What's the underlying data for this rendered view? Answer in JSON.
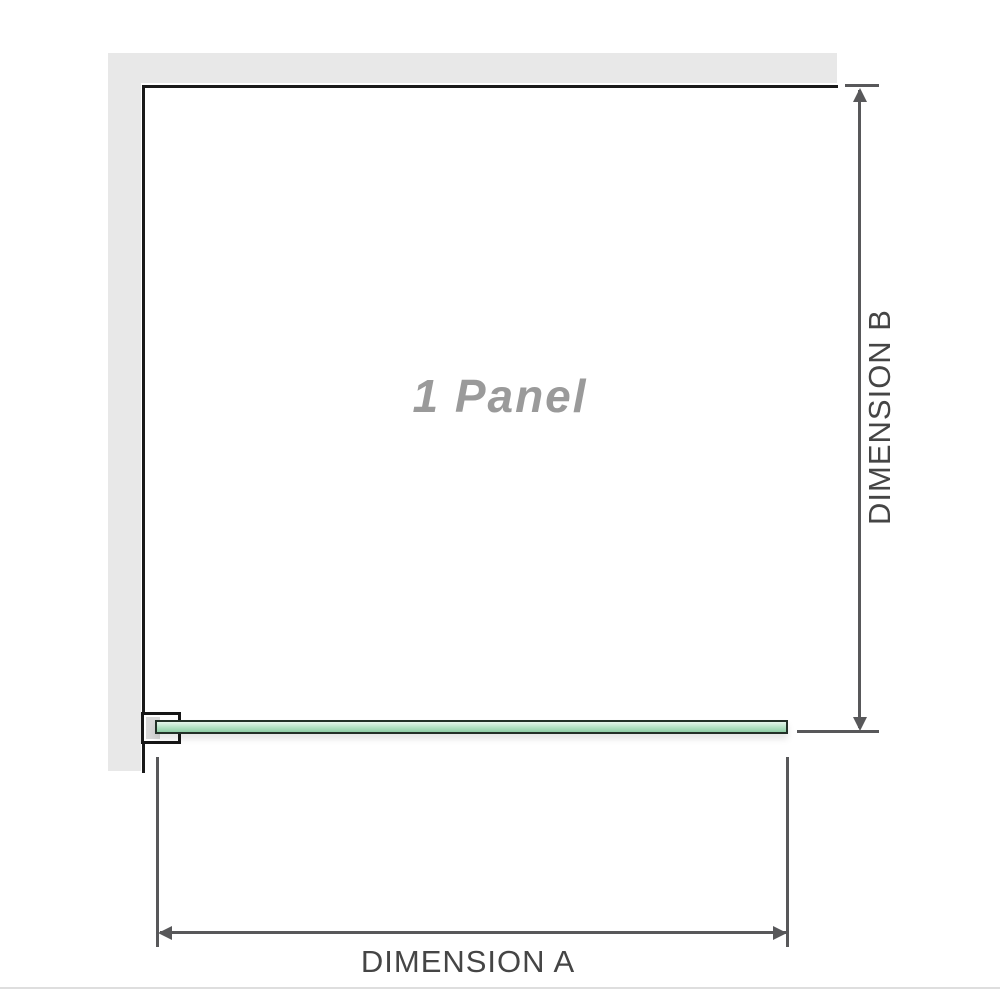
{
  "diagram": {
    "panel_label": "1 Panel",
    "dimension_a_label": "DIMENSION A",
    "dimension_b_label": "DIMENSION B"
  },
  "colors": {
    "background": "#ffffff",
    "wall_fill": "#e8e8e8",
    "wall_edge": "#1a1a1a",
    "glass_border": "#223027",
    "glass_fill_top": "#e6f5eb",
    "glass_fill_mid": "#b2e0c3",
    "glass_fill_bottom": "#8ecda5",
    "bracket_border": "#161616",
    "bracket_fill": "#ffffff",
    "bracket_pad": "#d8d8d8",
    "dimension_line": "#58585a",
    "dimension_text": "#454545",
    "panel_text": "#9a9a9a",
    "divider": "#dedede"
  }
}
